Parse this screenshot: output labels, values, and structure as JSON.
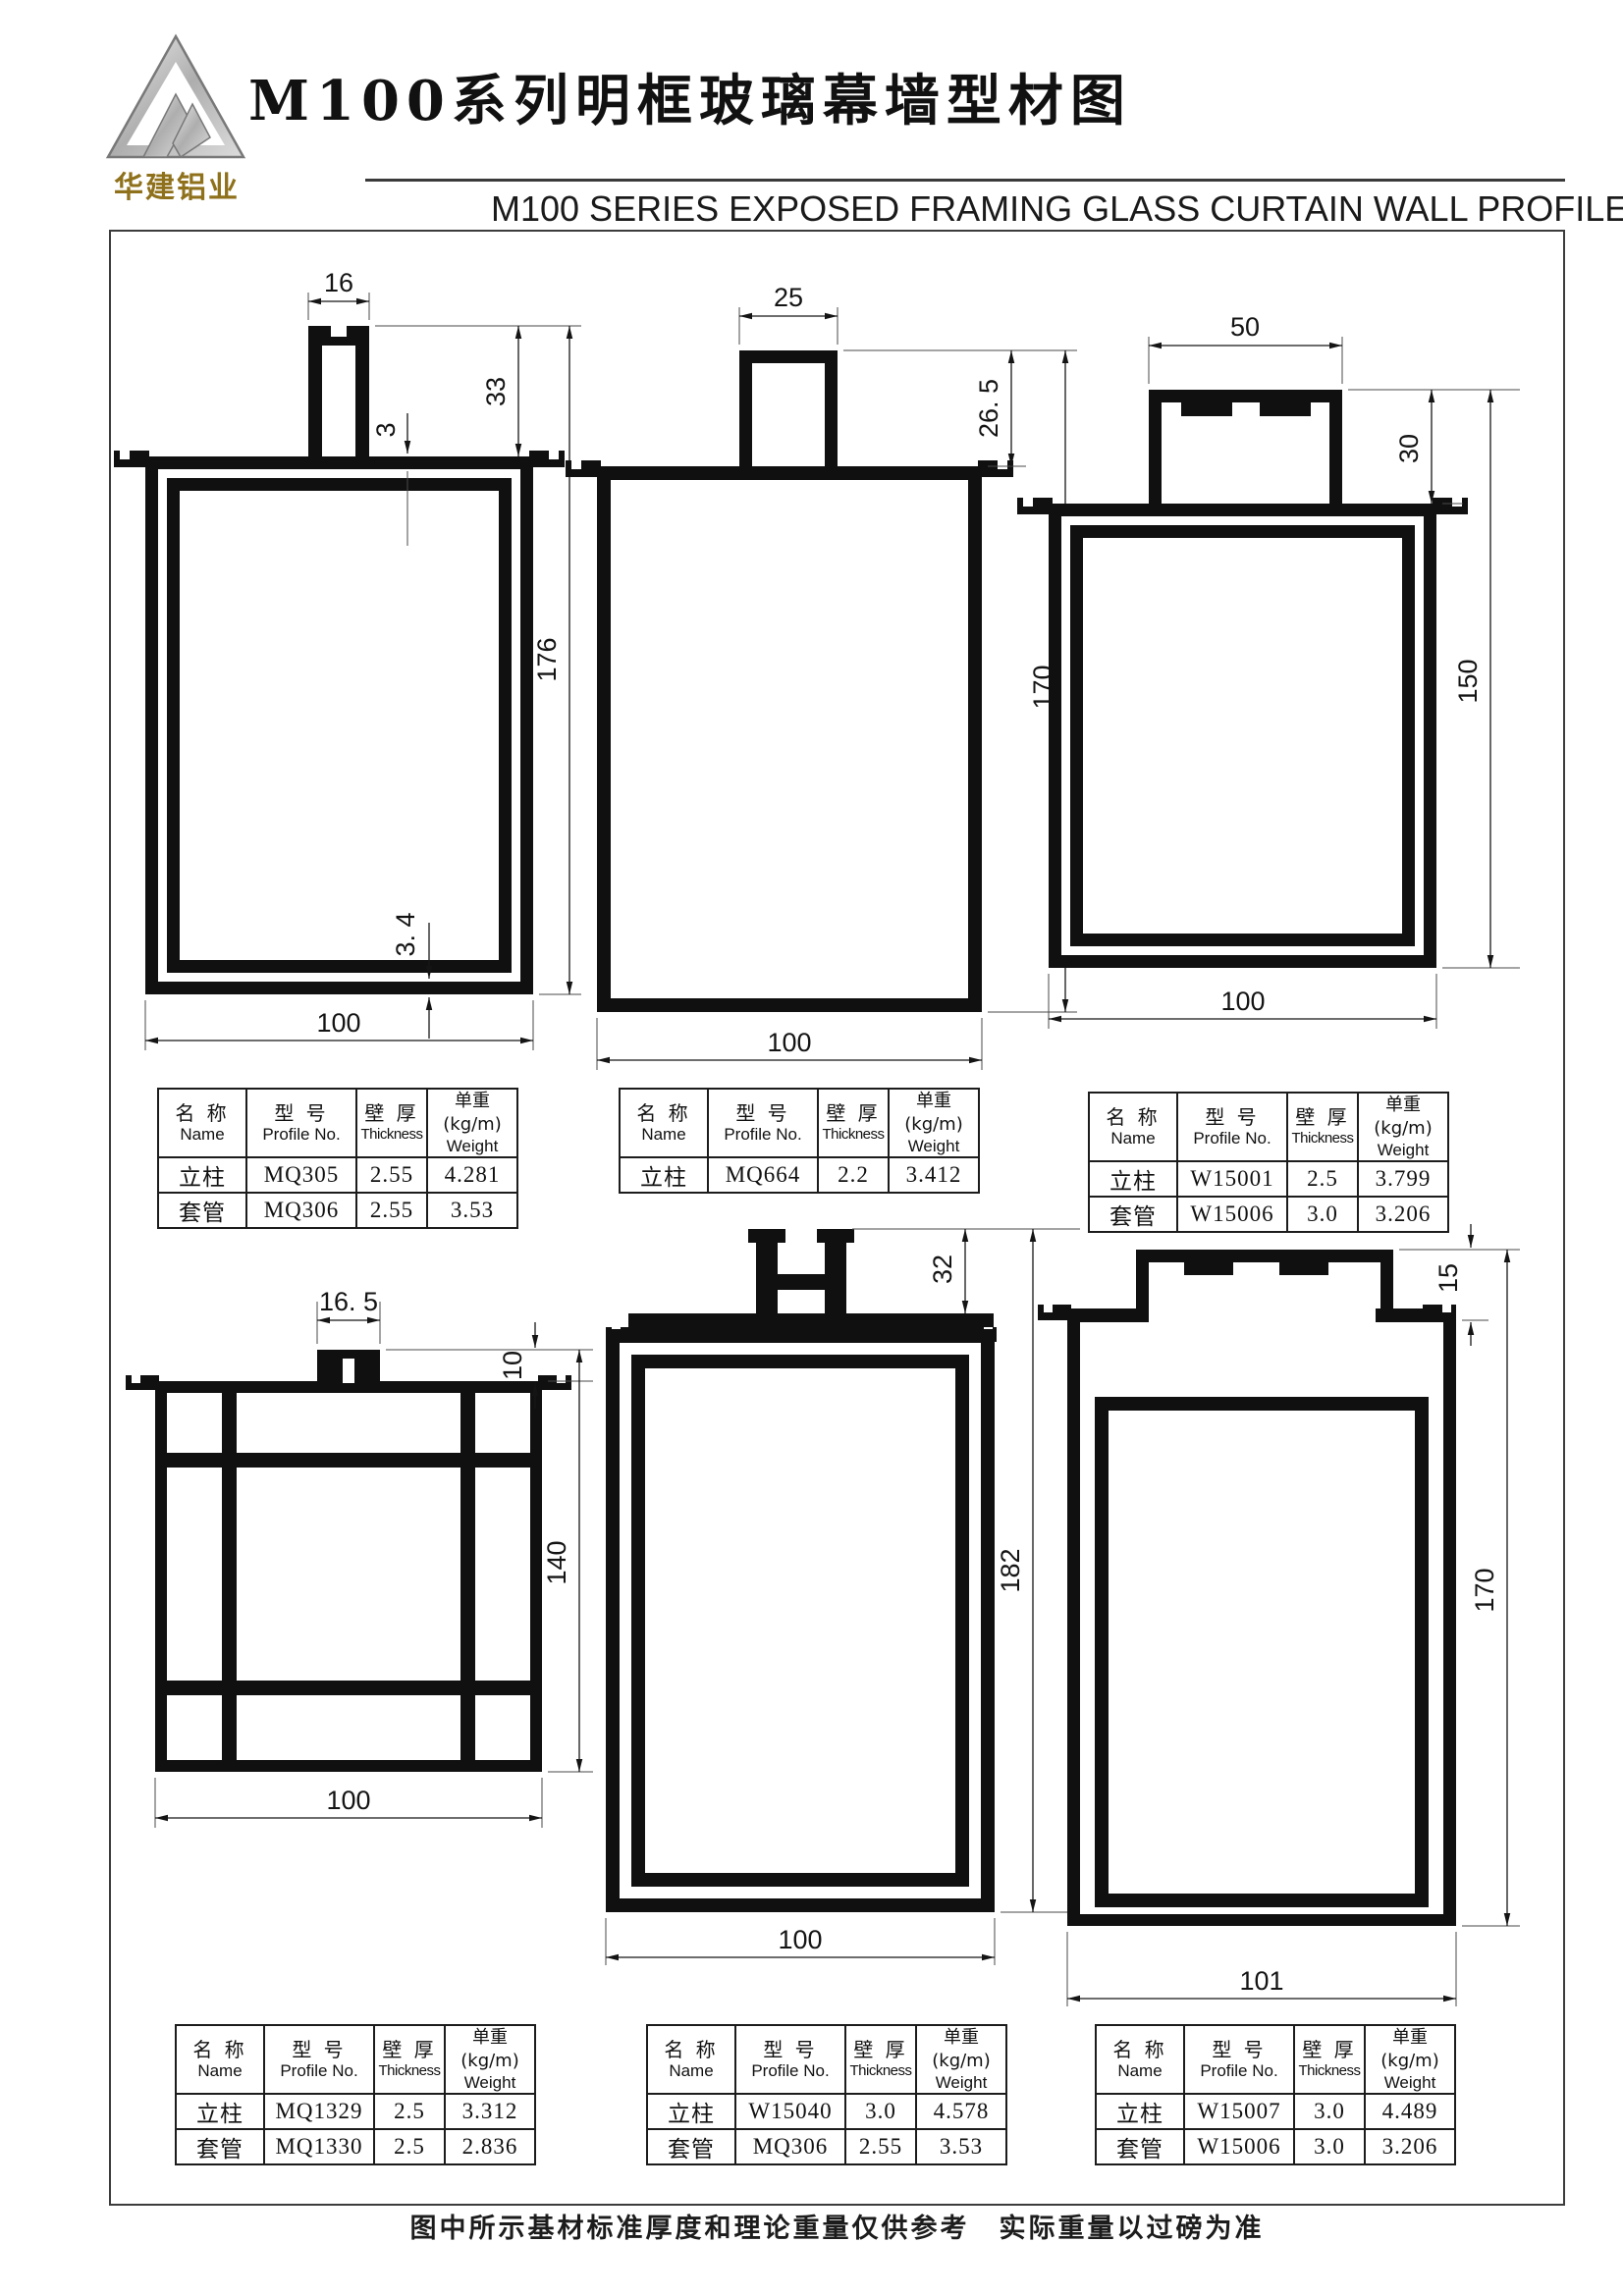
{
  "page": {
    "logo_text": "华建铝业",
    "title_cn": "M100系列明框玻璃幕墙型材图",
    "title_en": "M100  SERIES EXPOSED FRAMING GLASS CURTAIN WALL PROFILES",
    "footer_note": "图中所示基材标准厚度和理论重量仅供参考　实际重量以过磅为准"
  },
  "table_headers": {
    "name_cn": "名 称",
    "name_en": "Name",
    "profile_cn": "型 号",
    "profile_en": "Profile No.",
    "thickness_cn": "壁 厚",
    "thickness_en": "Thickness",
    "weight_cn": "单重(kg/m)",
    "weight_en": "Weight"
  },
  "profiles": [
    {
      "dims": {
        "stem_width": "16",
        "stem_height": "33",
        "top_wall": "3",
        "height": "176",
        "bottom_wall": "3. 4",
        "width": "100"
      },
      "rows": [
        {
          "name": "立柱",
          "profile_no": "MQ305",
          "thickness": "2.55",
          "weight": "4.281"
        },
        {
          "name": "套管",
          "profile_no": "MQ306",
          "thickness": "2.55",
          "weight": "3.53"
        }
      ]
    },
    {
      "dims": {
        "stem_width": "25",
        "stem_height": "26. 5",
        "height": "170",
        "width": "100"
      },
      "rows": [
        {
          "name": "立柱",
          "profile_no": "MQ664",
          "thickness": "2.2",
          "weight": "3.412"
        }
      ]
    },
    {
      "dims": {
        "head_width": "50",
        "head_height": "30",
        "height": "150",
        "width": "100"
      },
      "rows": [
        {
          "name": "立柱",
          "profile_no": "W15001",
          "thickness": "2.5",
          "weight": "3.799"
        },
        {
          "name": "套管",
          "profile_no": "W15006",
          "thickness": "3.0",
          "weight": "3.206"
        }
      ]
    },
    {
      "dims": {
        "stem_width": "16. 5",
        "stem_height": "10",
        "height": "140",
        "width": "100"
      },
      "rows": [
        {
          "name": "立柱",
          "profile_no": "MQ1329",
          "thickness": "2.5",
          "weight": "3.312"
        },
        {
          "name": "套管",
          "profile_no": "MQ1330",
          "thickness": "2.5",
          "weight": "2.836"
        }
      ]
    },
    {
      "dims": {
        "stem_height": "32",
        "height": "182",
        "width": "100"
      },
      "rows": [
        {
          "name": "立柱",
          "profile_no": "W15040",
          "thickness": "3.0",
          "weight": "4.578"
        },
        {
          "name": "套管",
          "profile_no": "MQ306",
          "thickness": "2.55",
          "weight": "3.53"
        }
      ]
    },
    {
      "dims": {
        "step_height": "15",
        "height": "170",
        "width": "101"
      },
      "rows": [
        {
          "name": "立柱",
          "profile_no": "W15007",
          "thickness": "3.0",
          "weight": "4.489"
        },
        {
          "name": "套管",
          "profile_no": "W15006",
          "thickness": "3.0",
          "weight": "3.206"
        }
      ]
    }
  ]
}
